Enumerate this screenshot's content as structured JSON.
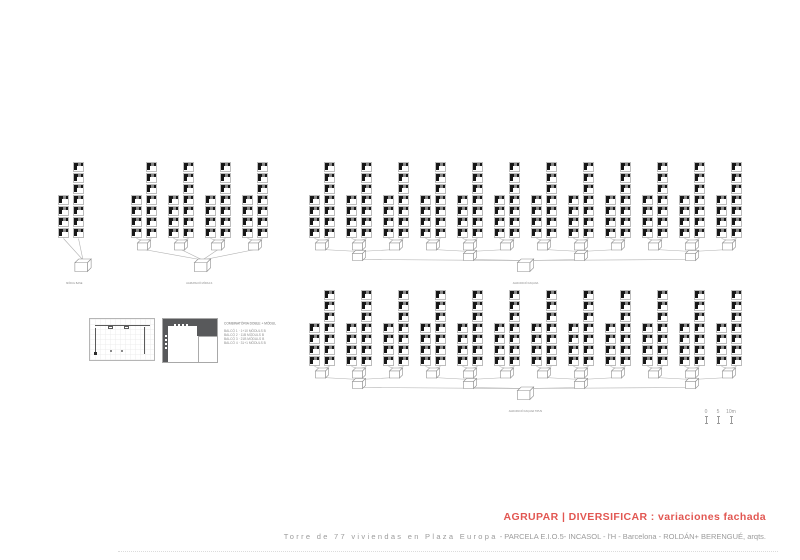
{
  "footer": {
    "title": "AGRUPAR | DIVERSIFICAR : variaciones fachada",
    "subtitle_spaced": "Torre de 77 viviendas en Plaza Europa",
    "subtitle_rest": "- PARCELA E.I.O.5- INCASOL - l'H - Barcelona - ROLDÁN+ BERENGUÉ, arqts.",
    "accent_color": "#e25752",
    "subtitle_color": "#9b9b9b"
  },
  "scale_bar": {
    "labels": [
      "0",
      "5",
      "10m"
    ]
  },
  "legend": {
    "heading": "COMBINATÒRIA DOBLE + MÒDUL",
    "items": [
      "BALCÓ 1 · 1+10 MÒDULS B",
      "BALCÓ 2 · 11B MÒDULS B",
      "BALCÓ 3 · 21B MÒDULS B",
      "BALCÓ 4 · 31+1 MÒDULS B"
    ]
  },
  "diagram": {
    "ink_color": "#171717",
    "line_color": "#b0b0b0",
    "modules_per_tall_column": 7,
    "modules_per_short_column": 4,
    "groups": [
      {
        "name": "group-single-pair",
        "x": 58,
        "y": 162,
        "pairs": 1,
        "levels": 0,
        "final_offset": 12,
        "caption": "MÒDUL BASE"
      },
      {
        "name": "group-four-pairs",
        "x": 131,
        "y": 162,
        "pairs": 4,
        "levels": 1,
        "final_offset": 3,
        "caption": "AGRUPACIÓ MÒDULS"
      },
      {
        "name": "group-facade-row-1",
        "x": 309,
        "y": 162,
        "pairs": 12,
        "levels": 2,
        "final_offset": 0,
        "caption": "AGRUPACIÓ FAÇANA"
      },
      {
        "name": "group-facade-row-2",
        "x": 309,
        "y": 290,
        "pairs": 12,
        "levels": 2,
        "final_offset": 0,
        "caption": "AGRUPACIÓ FAÇANA TIPUS"
      }
    ]
  }
}
